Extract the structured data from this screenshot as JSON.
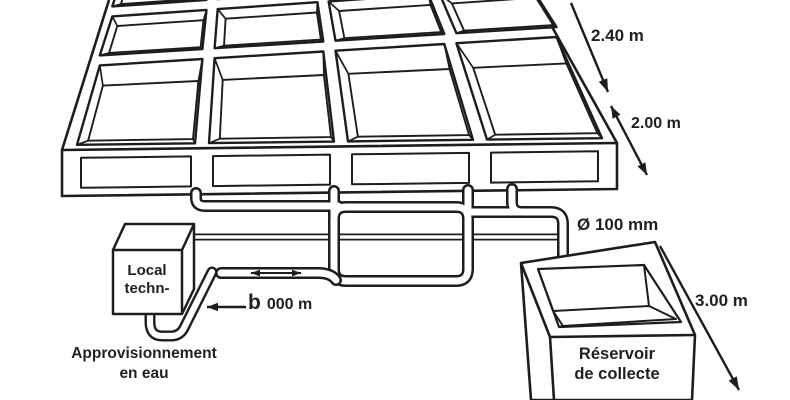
{
  "diagram": {
    "kind": "isometric technical diagram",
    "subject": "basin farm with water supply and collection circuit",
    "background": "#ffffff",
    "line_color": "#1d1d1b",
    "text_color": "#231f20"
  },
  "basin_grid": {
    "rows_visible": 3,
    "columns": 4,
    "basins_visible": 12
  },
  "dimensions": {
    "basin_length": "2.40 m",
    "basin_width": "2.00 m",
    "pipe_diameter": "Ø 100 mm",
    "reservoir_dimension": "3.00 m",
    "pipe_length_prefix": "b",
    "pipe_length_rest": "000 m"
  },
  "labels": {
    "technical_room_line1": "Local",
    "technical_room_line2": "techn-",
    "water_supply_line1": "Approvisionnement",
    "water_supply_line2": "en eau",
    "reservoir_line1": "Réservoir",
    "reservoir_line2": "de collecte"
  }
}
